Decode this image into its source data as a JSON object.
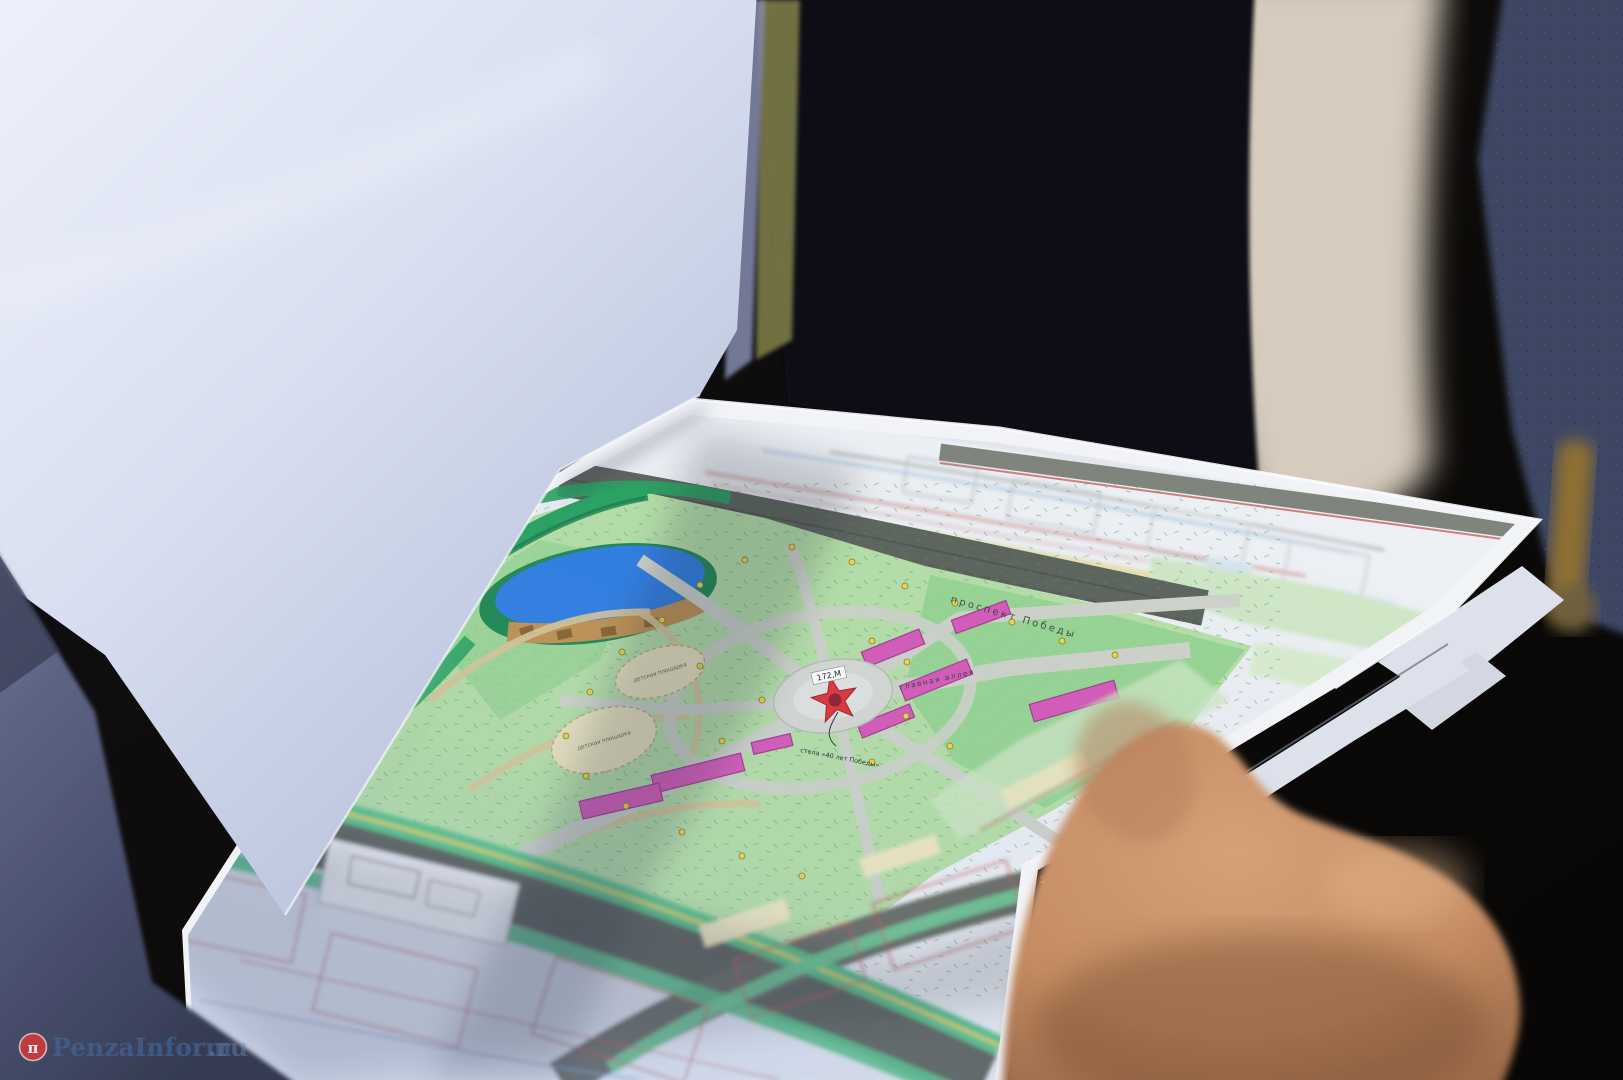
{
  "scene": {
    "alt": "Photograph: hands holding a printed colour master plan of a Victory park; a folded white sheet covers the upper-left of the map"
  },
  "watermark": {
    "logo_glyph": "π",
    "name": "PenzaInform",
    "tld": ".ru"
  },
  "map_labels": {
    "avenue_top": "проспект Победы",
    "avenue_top_2": "проспект Победы",
    "main_alley": "главная аллея",
    "elevation_mark": "172,М",
    "playground_a": "детская площадка",
    "playground_b": "детская площадка",
    "stela": "стела «40 лет Победы»"
  },
  "colors": {
    "background_dark": "#0e0b09",
    "suit_dark": "#0c0d13",
    "flap_white": "#e9edf8",
    "sleeve_fabric": "#5a6180",
    "cream_blur": "#d6cbbc",
    "navy_fabric": "#3c4763",
    "gold_blur": "#8f6f33",
    "sheet_white": "#f1f3f7",
    "undersheet": "#dce1eb",
    "park_light": "#b6e0a6",
    "park_mid": "#93d48e",
    "tree_green": "#27a35e",
    "street_gray": "#5d635a",
    "path_gray": "#cfd4c9",
    "alley_tan": "#d9c897",
    "plaza_gray": "#d6dad3",
    "pond_blue": "#2e7ee2",
    "beach_tan": "#c2924f",
    "playground_beige": "#eae4bd",
    "flower_pink": "#d75ab8",
    "lamp_yellow": "#ecd84e",
    "star_red": "#e23434",
    "star_dark": "#8e1f2e",
    "block_fill": "#e3e9f1",
    "block_line_red": "#c05656",
    "cadastral_white": "#eef1f4",
    "topband_gray": "#72796e",
    "skin": "#c48c63",
    "watermark_red": "#cc3a3c",
    "watermark_blue": "#44699e"
  }
}
